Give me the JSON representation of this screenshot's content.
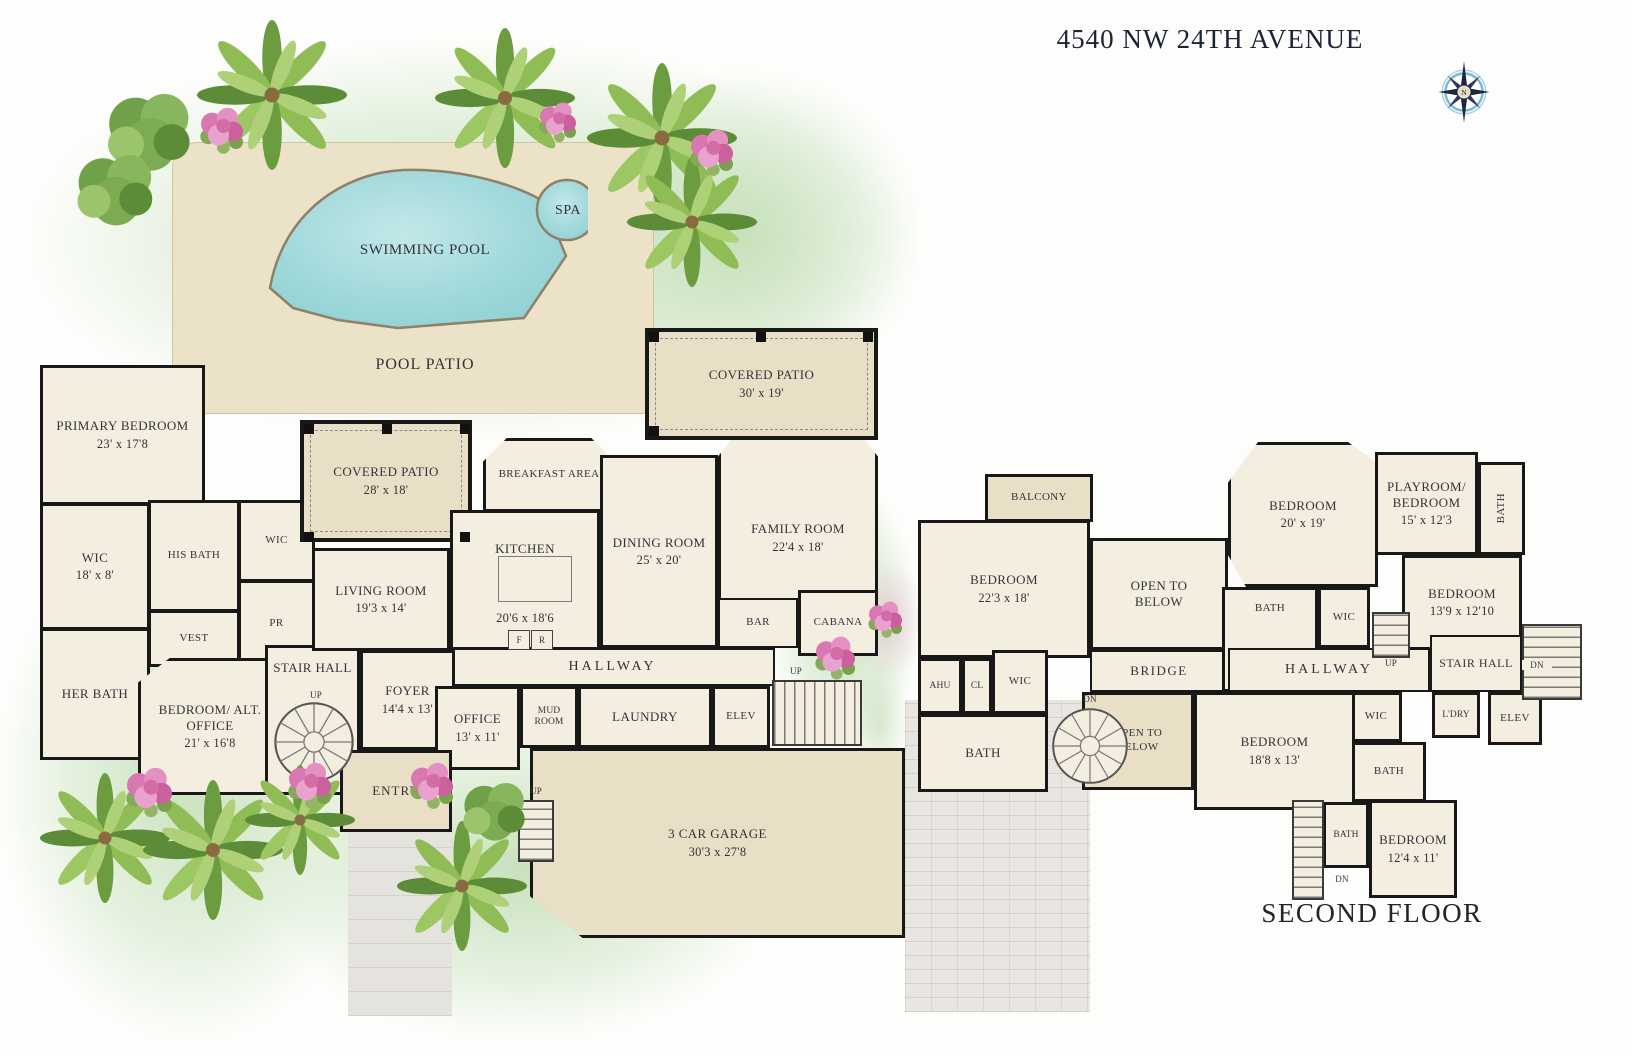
{
  "title": "4540 NW 24TH AVENUE",
  "compass": "N",
  "floor_label_second": "SECOND FLOOR",
  "pool_area": {
    "pool": "SWIMMING POOL",
    "spa": "SPA",
    "deck": "POOL PATIO"
  },
  "dir": {
    "up": "UP",
    "dn": "DN"
  },
  "kitchen_marks": {
    "f": "F",
    "r": "R"
  },
  "ff": {
    "rooms": [
      {
        "name": "PRIMARY BEDROOM",
        "dims": "23' x 17'8"
      },
      {
        "name": "WIC",
        "dims": "18' x 8'"
      },
      {
        "name": "HIS BATH"
      },
      {
        "name": "WIC"
      },
      {
        "name": "VEST"
      },
      {
        "name": "PR"
      },
      {
        "name": "HER BATH"
      },
      {
        "name": "BEDROOM/ ALT. OFFICE",
        "dims": "21' x 16'8"
      },
      {
        "name": "STAIR HALL"
      },
      {
        "name": "LIVING ROOM",
        "dims": "19'3 x 14'"
      },
      {
        "name": "COVERED PATIO",
        "dims": "28' x 18'"
      },
      {
        "name": "BREAKFAST AREA"
      },
      {
        "name": "KITCHEN",
        "dims": "20'6 x 18'6"
      },
      {
        "name": "DINING ROOM",
        "dims": "25' x 20'"
      },
      {
        "name": "FAMILY ROOM",
        "dims": "22'4 x 18'"
      },
      {
        "name": "COVERED PATIO",
        "dims": "30' x 19'"
      },
      {
        "name": "BAR"
      },
      {
        "name": "CABANA"
      },
      {
        "name": "HALLWAY"
      },
      {
        "name": "FOYER",
        "dims": "14'4 x 13'"
      },
      {
        "name": "OFFICE",
        "dims": "13' x 11'"
      },
      {
        "name": "MUD ROOM"
      },
      {
        "name": "LAUNDRY"
      },
      {
        "name": "ELEV"
      },
      {
        "name": "ENTRY"
      },
      {
        "name": "3 CAR GARAGE",
        "dims": "30'3 x 27'8"
      }
    ]
  },
  "sf": {
    "rooms": [
      {
        "name": "BALCONY"
      },
      {
        "name": "BEDROOM",
        "dims": "22'3 x 18'"
      },
      {
        "name": "OPEN TO BELOW"
      },
      {
        "name": "BRIDGE"
      },
      {
        "name": "AHU"
      },
      {
        "name": "CL"
      },
      {
        "name": "WIC"
      },
      {
        "name": "BATH"
      },
      {
        "name": "OPEN TO BELOW"
      },
      {
        "name": "BEDROOM",
        "dims": "20' x 19'"
      },
      {
        "name": "BATH"
      },
      {
        "name": "LIN"
      },
      {
        "name": "WIC"
      },
      {
        "name": "PLAYROOM/ BEDROOM",
        "dims": "15' x 12'3"
      },
      {
        "name": "BATH"
      },
      {
        "name": "BEDROOM",
        "dims": "13'9 x 12'10"
      },
      {
        "name": "HALLWAY"
      },
      {
        "name": "STAIR HALL"
      },
      {
        "name": "L'DRY"
      },
      {
        "name": "ELEV"
      },
      {
        "name": "WIC"
      },
      {
        "name": "BEDROOM",
        "dims": "18'8 x 13'"
      },
      {
        "name": "BATH"
      },
      {
        "name": "BATH"
      },
      {
        "name": "BEDROOM",
        "dims": "12'4 x 11'"
      }
    ]
  }
}
